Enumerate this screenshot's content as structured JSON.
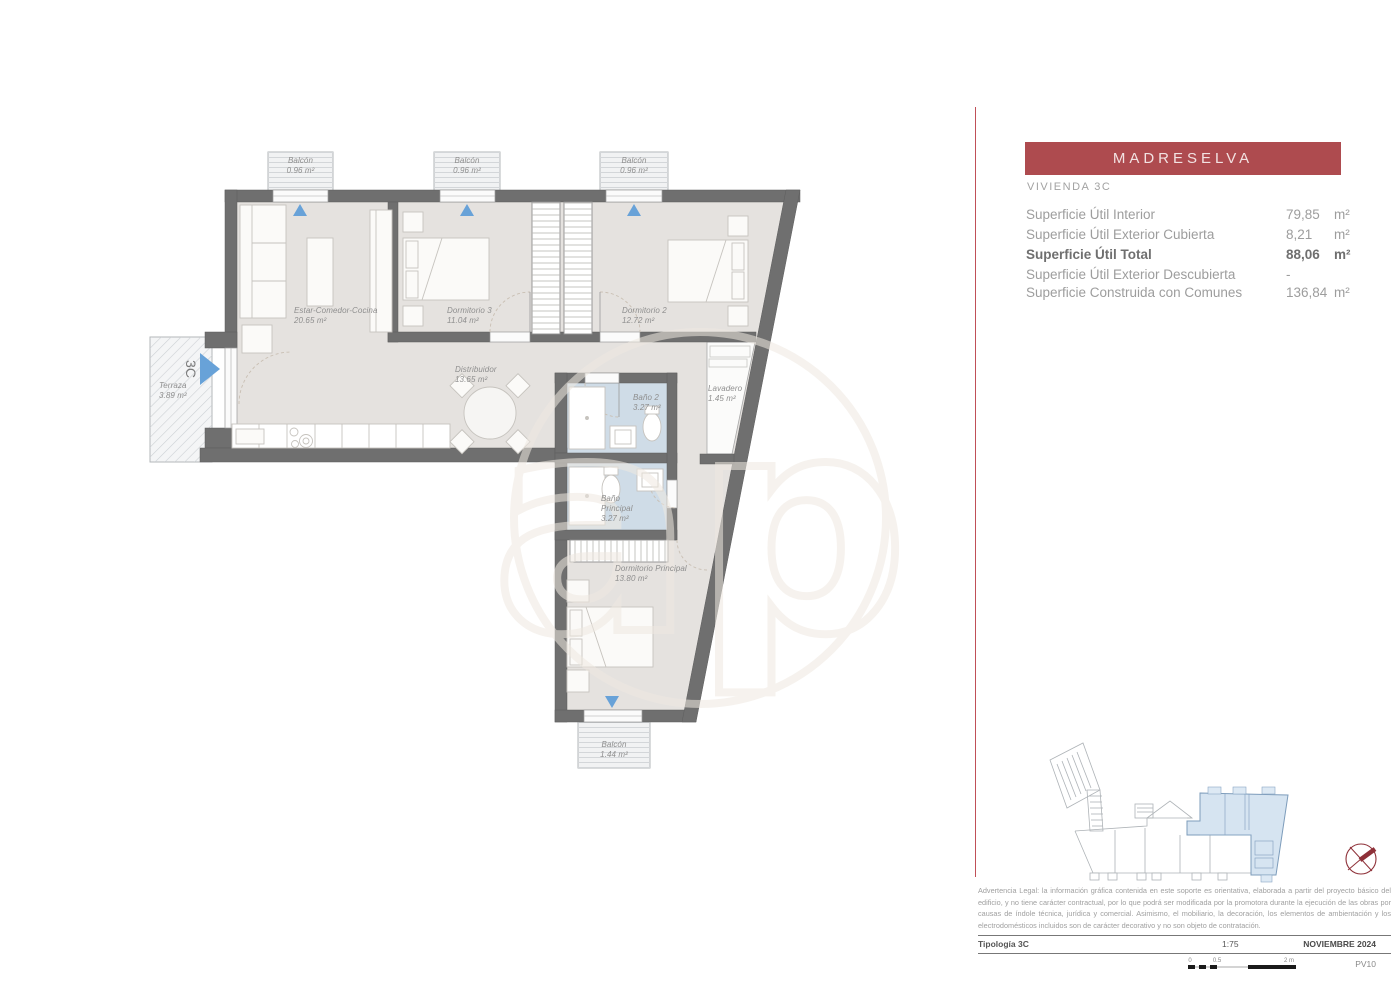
{
  "info_panel": {
    "title": "MADRESELVA",
    "subtitle": "VIVIENDA 3C",
    "rows": [
      {
        "label": "Superficie Útil Interior",
        "value": "79,85",
        "unit": "m²"
      },
      {
        "label": "Superficie Útil Exterior Cubierta",
        "value": "8,21",
        "unit": "m²"
      },
      {
        "label": "Superficie Útil Total",
        "value": "88,06",
        "unit": "m²"
      },
      {
        "label": "Superficie Útil Exterior Descubierta",
        "value": "-",
        "unit": ""
      },
      {
        "label": "Superficie Construida con Comunes",
        "value": "136,84",
        "unit": "m²"
      }
    ]
  },
  "plan": {
    "entrance_label": "3C",
    "watermark": "ap",
    "rooms": {
      "balcon_1": {
        "name": "Balcón",
        "area": "0.96 m²"
      },
      "balcon_2": {
        "name": "Balcón",
        "area": "0.96 m²"
      },
      "balcon_3": {
        "name": "Balcón",
        "area": "0.96 m²"
      },
      "estar": {
        "name": "Estar-Comedor-Cocina",
        "area": "20.65 m²"
      },
      "dormitorio_3": {
        "name": "Dormitorio 3",
        "area": "11.04 m²"
      },
      "dormitorio_2": {
        "name": "Dormitorio 2",
        "area": "12.72 m²"
      },
      "terraza": {
        "name": "Terraza",
        "area": "3.89 m²"
      },
      "distribuidor": {
        "name": "Distribuidor",
        "area": "13.65 m²"
      },
      "bano_2": {
        "name": "Baño 2",
        "area": "3.27 m²"
      },
      "lavadero": {
        "name": "Lavadero",
        "area": "1.45 m²"
      },
      "bano_principal": {
        "name": "Baño",
        "name2": "Principal",
        "area": "3.27 m²"
      },
      "dormitorio_principal": {
        "name": "Dormitorio Principal",
        "area": "13.80 m²"
      },
      "balcon_inferior": {
        "name": "Balcón",
        "area": "1.44 m²"
      }
    }
  },
  "footer": {
    "legal": "Advertencia Legal: la información gráfica contenida en este soporte es orientativa, elaborada a partir del proyecto básico del edificio, y no tiene carácter contractual, por lo que podrá ser modificada por la promotora durante la ejecución de las obras por causas de índole técnica, jurídica y comercial. Asimismo, el mobiliario, la decoración, los elementos de ambientación y los electrodomésticos incluidos son de carácter decorativo y no son objeto de contratación.",
    "tipologia": "Tipología 3C",
    "scale": "1:75",
    "date": "NOVIEMBRE 2024",
    "code": "PV10",
    "scalebar_ticks": [
      "0",
      "0.5",
      "2 m"
    ]
  },
  "colors": {
    "banner": "#ae4b4f",
    "divider_line": "#c05058",
    "wall": "#6f6f6f",
    "floor": "#e5e2df",
    "bathroom_floor": "#cfdce7",
    "entry_arrow": "#68a2d8",
    "compass": "#8e3038",
    "site_plan_highlight": "#cfdfee"
  }
}
